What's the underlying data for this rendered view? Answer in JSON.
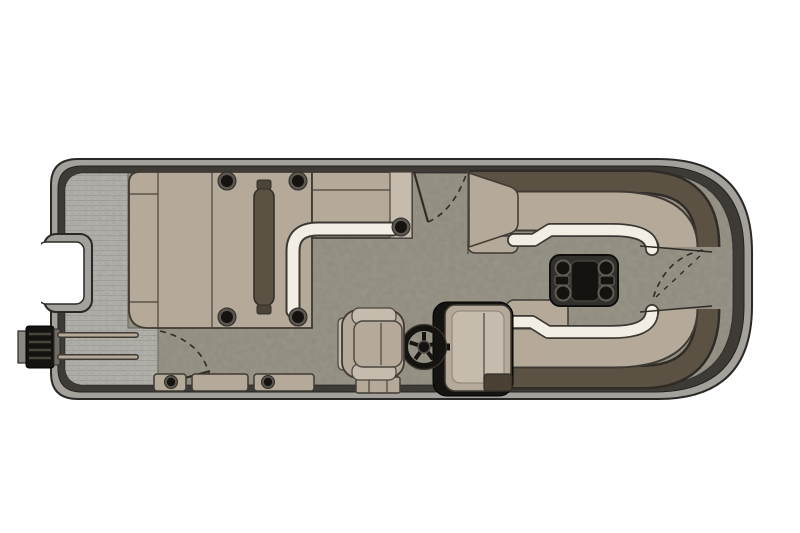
{
  "scene": {
    "type": "pontoon-boat-floorplan-top-view",
    "components": [
      "swim-platform",
      "boarding-ladder",
      "stern-notch",
      "rear-sun-lounger",
      "backrest-divider",
      "chaise-lounge",
      "side-bench",
      "port-stern-gate",
      "starboard-boarding-gate",
      "kick-panels",
      "helm-console",
      "steering-wheel",
      "captains-chair",
      "bow-starboard-lounge",
      "bow-port-lounge",
      "table-mount-plate",
      "bow-gate",
      "bow-deck",
      "cup-holders"
    ]
  },
  "colors": {
    "page_bg": "#ffffff",
    "hull_band": "#a4a19c",
    "hull_outline": "#2b2927",
    "fence": "#3e3b37",
    "deck": "#8e8a7d",
    "weave_base": "#b3b1ad",
    "weave_line": "#9e9c98",
    "weave_dash": "#a7a5a1",
    "seat_tan": "#b5aa9a",
    "seat_light": "#c6bcae",
    "white_edge": "#f2eee4",
    "backrest_brown": "#5c5243",
    "black": "#15130f",
    "table_black": "#32302c",
    "console_mat": "#4a4134",
    "cup_ring": "#5b564f"
  }
}
